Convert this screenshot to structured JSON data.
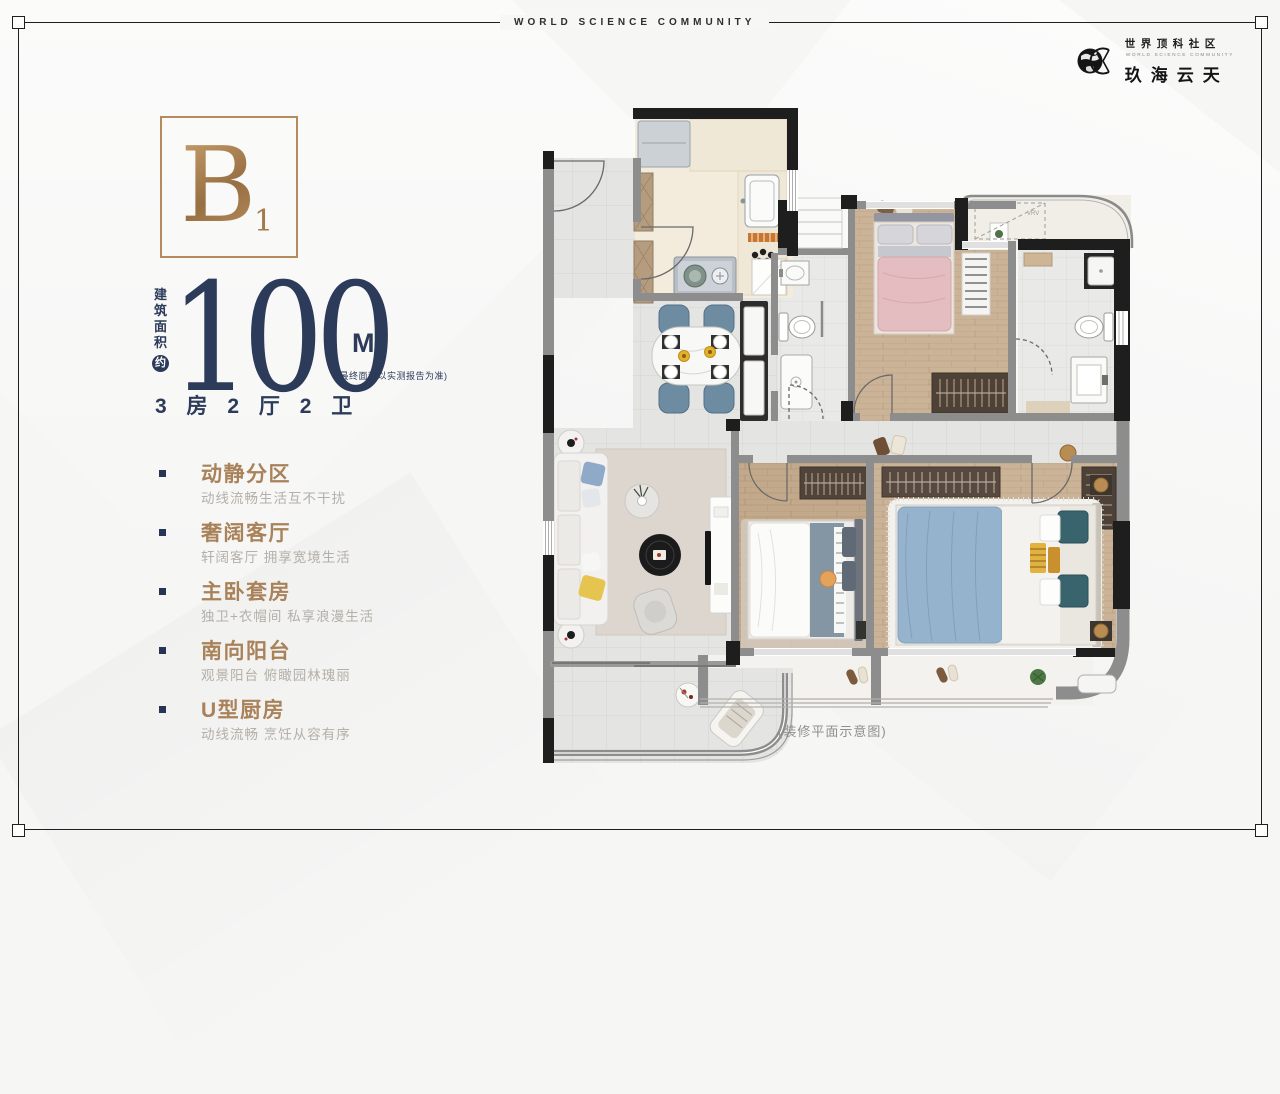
{
  "frame": {
    "tagline": "WORLD SCIENCE COMMUNITY"
  },
  "logo": {
    "community_cn": "世界顶科社区",
    "community_en": "WORLD SCIENCE COMMUNITY",
    "brand_cn": "玖海云天"
  },
  "unit": {
    "type_letter": "B",
    "type_sub": "1",
    "area_label": "建筑面积",
    "area_approx": "约",
    "area_value": "100",
    "area_unit": "M",
    "area_sup": "2",
    "area_note": "(最终面积以实测报告为准)",
    "rooms": "3 房 2 厅 2 卫"
  },
  "features": [
    {
      "title": "动静分区",
      "desc": "动线流畅生活互不干扰"
    },
    {
      "title": "奢阔客厅",
      "desc": "轩阔客厅 拥享宽境生活"
    },
    {
      "title": "主卧套房",
      "desc": "独卫+衣帽间 私享浪漫生活"
    },
    {
      "title": "南向阳台",
      "desc": "观景阳台 俯瞰园林瑰丽"
    },
    {
      "title": "U型厨房",
      "desc": "动线流畅 烹饪从容有序"
    }
  ],
  "floorplan": {
    "caption": "(装修平面示意图)",
    "vrv_label": "VRV"
  },
  "colors": {
    "navy": "#2c3b5a",
    "gold": "#a9825a",
    "gold_border": "#b58a5c",
    "wall_black": "#1e1e1e",
    "wall_gray": "#8d8d8d",
    "wood_floor": "#cbb397",
    "pink_bed": "#e4bdc0",
    "blue_bed": "#96b3cd",
    "chair_blue": "#6d8ba1"
  }
}
